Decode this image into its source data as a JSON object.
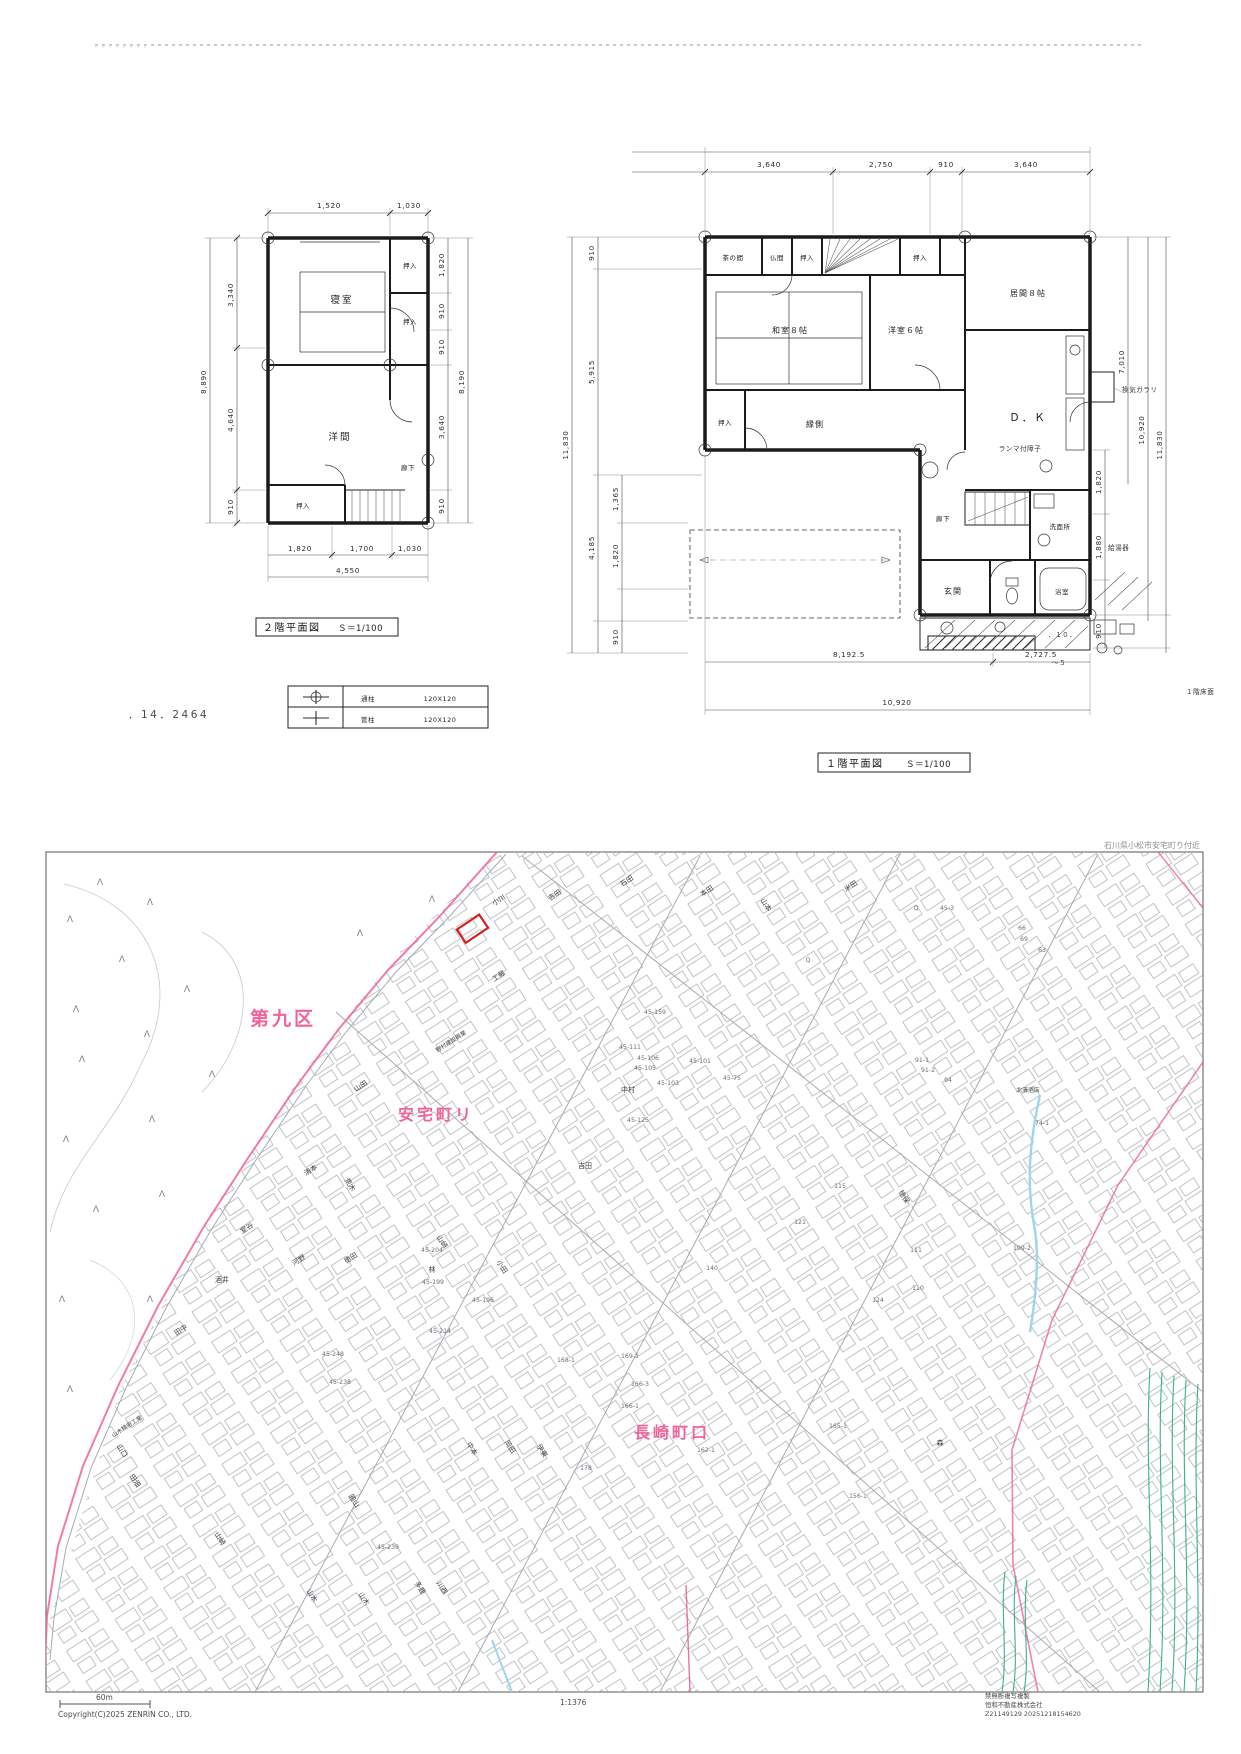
{
  "plan2f": {
    "title": "２階平面図",
    "scale": "Ｓ＝1/100",
    "rooms": {
      "shinshitsu": "寝室",
      "oshiire_a": "押入",
      "oshiire_b": "押入",
      "youma": "洋間",
      "oshiire_c": "押入",
      "rouka": "廊下"
    },
    "dims": {
      "top": [
        "1,520",
        "1,030"
      ],
      "left_segments": [
        "3,340",
        "4,640",
        "910"
      ],
      "left_total": "8,890",
      "right_segments": [
        "1,820",
        "910",
        "910",
        "3,640",
        "910"
      ],
      "right_total": "8,190",
      "bottom_segments": [
        "1,820",
        "1,700",
        "1,030"
      ],
      "bottom_total": "4,550"
    },
    "note_left": "．14．2464",
    "pillar_table": {
      "rows": [
        {
          "name": "通柱",
          "size": "120X120"
        },
        {
          "name": "管柱",
          "size": "120X120"
        }
      ]
    }
  },
  "plan1f": {
    "title": "１階平面図",
    "scale": "Ｓ＝1/100",
    "rooms": {
      "chanoma": "茶の間",
      "butsuma": "仏間",
      "oshiire_a": "押入",
      "oshiire_b": "押入",
      "ima": "居間８帖",
      "washitsu": "和室８帖",
      "yoshitsu": "洋室６帖",
      "engawa": "縁側",
      "oshiire_c": "押入",
      "dk": "Ｄ．Ｋ",
      "ranma": "ランマ付障子",
      "rouka": "廊下",
      "senmenjo": "洗面所",
      "genkan": "玄関",
      "yokushitsu": "浴室"
    },
    "annotations": {
      "vent": "換気ガラリ",
      "heater": "給湯器",
      "floor_note": "１階床面",
      "n10": "．１０．",
      "n5": "～５"
    },
    "dims": {
      "top": [
        "3,640",
        "2,750",
        "910",
        "3,640"
      ],
      "left_total": "11,830",
      "left_mid": [
        "910",
        "5,915",
        "4,185"
      ],
      "left_inner": [
        "1,365",
        "1,820",
        "910"
      ],
      "right_inner": [
        "1,820",
        "1,880",
        "910"
      ],
      "right_cols": [
        "7,010",
        "10,920",
        "11,830"
      ],
      "bottom_segments": [
        "8,192.5",
        "2,727.5"
      ],
      "bottom_total": "10,920"
    }
  },
  "map": {
    "caption": "石川県小松市安宅町り付近",
    "tree_symbol": "Λ",
    "area_labels": [
      {
        "text": "第九区"
      },
      {
        "text": "安宅町リ"
      },
      {
        "text": "長崎町口"
      }
    ],
    "names": [
      "小川",
      "吉田",
      "石田",
      "本田",
      "山本",
      "米田",
      "工藤",
      "野村建設興業",
      "中村",
      "山田",
      "清本",
      "荒木",
      "河野",
      "徳田",
      "酒井",
      "山口",
      "田畑",
      "山木精密工業",
      "山木",
      "山木",
      "山崎",
      "山崎",
      "小田",
      "林",
      "室谷",
      "多鹿",
      "川西",
      "中本",
      "岡田",
      "伊東",
      "圓山",
      "森",
      "田中",
      "徳保",
      "北清酒店",
      "吉田"
    ],
    "lots": [
      "45-111",
      "45-106",
      "45-105",
      "45-101",
      "45-159",
      "45-103",
      "45-75",
      "45-125",
      "91-1",
      "91-2",
      "74-1",
      "94",
      "115",
      "121",
      "110",
      "111",
      "124",
      "109-2",
      "140",
      "45-204",
      "45-199",
      "45-196",
      "45-214",
      "45-248",
      "45-238",
      "45-239",
      "169-1",
      "168-1",
      "166-3",
      "166-1",
      "165-1",
      "162-1",
      "178",
      "156-1",
      "45-3",
      "63",
      "66",
      "69",
      "Q",
      "Q"
    ],
    "colors": {
      "boundary_pink": "#f0639b",
      "target_red": "#d42222",
      "stream_blue": "#9fd4ea",
      "field_green": "#3cb08f"
    },
    "footer": {
      "scale_len": "60m",
      "copyright": "Copyright(C)2025 ZENRIN CO., LTD.",
      "ratio": "1:1376",
      "notice1": "禁無断複写複製",
      "notice2": "恒和不動産株式会社",
      "notice3": "Z21149129 20251218154620"
    }
  }
}
